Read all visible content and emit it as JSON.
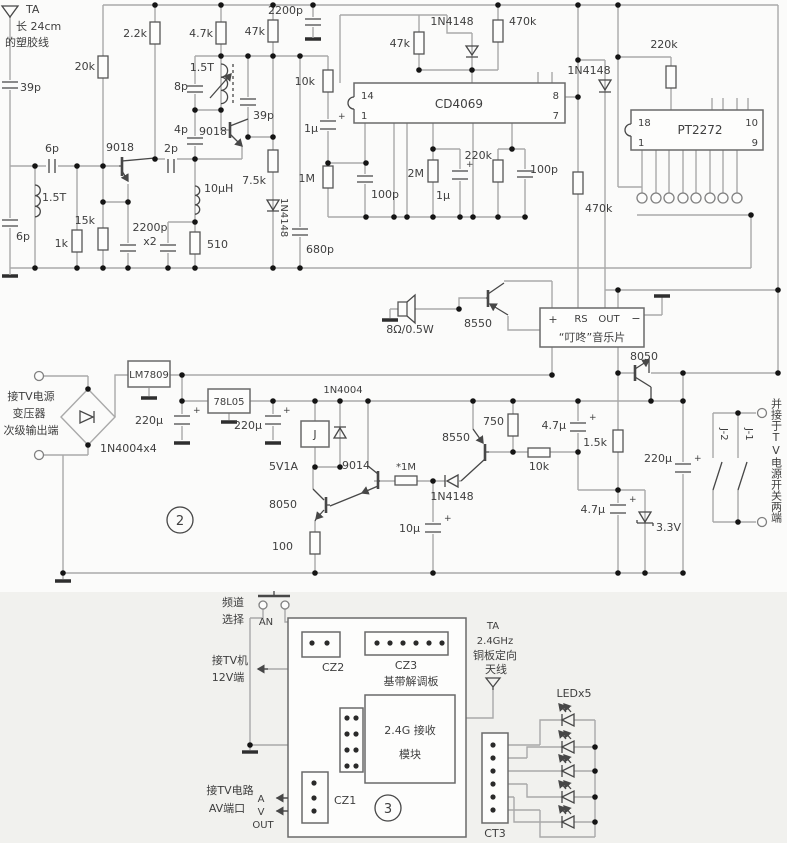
{
  "sym": {
    "plus": "+"
  },
  "top": {
    "ant_name": "TA",
    "ant_l1": "长 24cm",
    "ant_l2": "的塑胶线",
    "c39p_1": "39p",
    "c6p_1": "6p",
    "l15t_1": "1.5T",
    "c6p_2": "6p",
    "r1k": "1k",
    "r15k": "15k",
    "r20k": "20k",
    "r2k2": "2.2k",
    "q9018_1": "9018",
    "c2200p_l1": "2200p",
    "c2200p_l2": "x2",
    "r510": "510",
    "l10uh": "10µH",
    "c2p": "2p",
    "c4p": "4p",
    "c8p": "8p",
    "l15t_2": "1.5T",
    "q9018_2": "9018",
    "c39p_2": "39p",
    "r7k5": "7.5k",
    "d4148_1": "1N4148",
    "r4k7": "4.7k",
    "r47k_1": "47k",
    "c2200p_2": "2200p",
    "r10k": "10k",
    "c1u_1": "1µ",
    "r1m": "1M",
    "c680p": "680p",
    "c100p_1": "100p",
    "r2m": "2M",
    "c1u_2": "1µ",
    "r220k_1": "220k",
    "c100p_2": "100p",
    "r47k_2": "47k",
    "d4148_2": "1N4148",
    "r470k_1": "470k",
    "ic1": "CD4069",
    "ic1_p14": "14",
    "ic1_p1": "1",
    "ic1_p8": "8",
    "ic1_p7": "7",
    "d4148_3": "1N4148",
    "r470k_2": "470k",
    "r220k_2": "220k",
    "ic2": "PT2272",
    "ic2_p18": "18",
    "ic2_p1": "1",
    "ic2_p10": "10",
    "ic2_p9": "9"
  },
  "music": {
    "spk": "8Ω/0.5W",
    "q8550": "8550",
    "pin_plus": "+",
    "pin_rs": "RS",
    "pin_out": "OUT",
    "pin_minus": "−",
    "chip": "“叮咚”音乐片",
    "q8050": "8050"
  },
  "power": {
    "in_l1": "接TV电源",
    "in_l2": "变压器",
    "in_l3": "次级输出端",
    "bridge": "1N4004x4",
    "reg1": "LM7809",
    "c220u_1": "220µ",
    "reg2": "78L05",
    "c220u_2": "220µ",
    "badge": "2",
    "d4004": "1N4004",
    "relay": "J",
    "relay_rating": "5V1A",
    "q9014": "9014",
    "r1m_star": "*1M",
    "q8050": "8050",
    "r100": "100",
    "c10u": "10µ",
    "d4148": "1N4148",
    "q8550": "8550",
    "r750": "750",
    "r10k": "10k",
    "c4u7_1": "4.7µ",
    "r1k5": "1.5k",
    "c220u_3": "220µ",
    "c4u7_2": "4.7µ",
    "dz": "3.3V",
    "j1": "J-1",
    "j2": "J-2",
    "note": "并接于TV电源开关两端"
  },
  "rx": {
    "ch_l1": "频道",
    "ch_l2": "选择",
    "btn": "AN",
    "cz2": "CZ2",
    "cz3": "CZ3",
    "board": "基带解调板",
    "tv12_l1": "接TV机",
    "tv12_l2": "12V端",
    "mod_l1": "2.4G 接收",
    "mod_l2": "模块",
    "av_l1": "接TV电路",
    "av_l2": "AV端口",
    "a": "A",
    "v": "V",
    "out": "OUT",
    "cz1": "CZ1",
    "badge": "3",
    "ant_l1": "TA",
    "ant_l2": "2.4GHz",
    "ant_l3": "铜板定向",
    "ant_l4": "天线",
    "led": "LEDx5",
    "ct3": "CT3"
  }
}
